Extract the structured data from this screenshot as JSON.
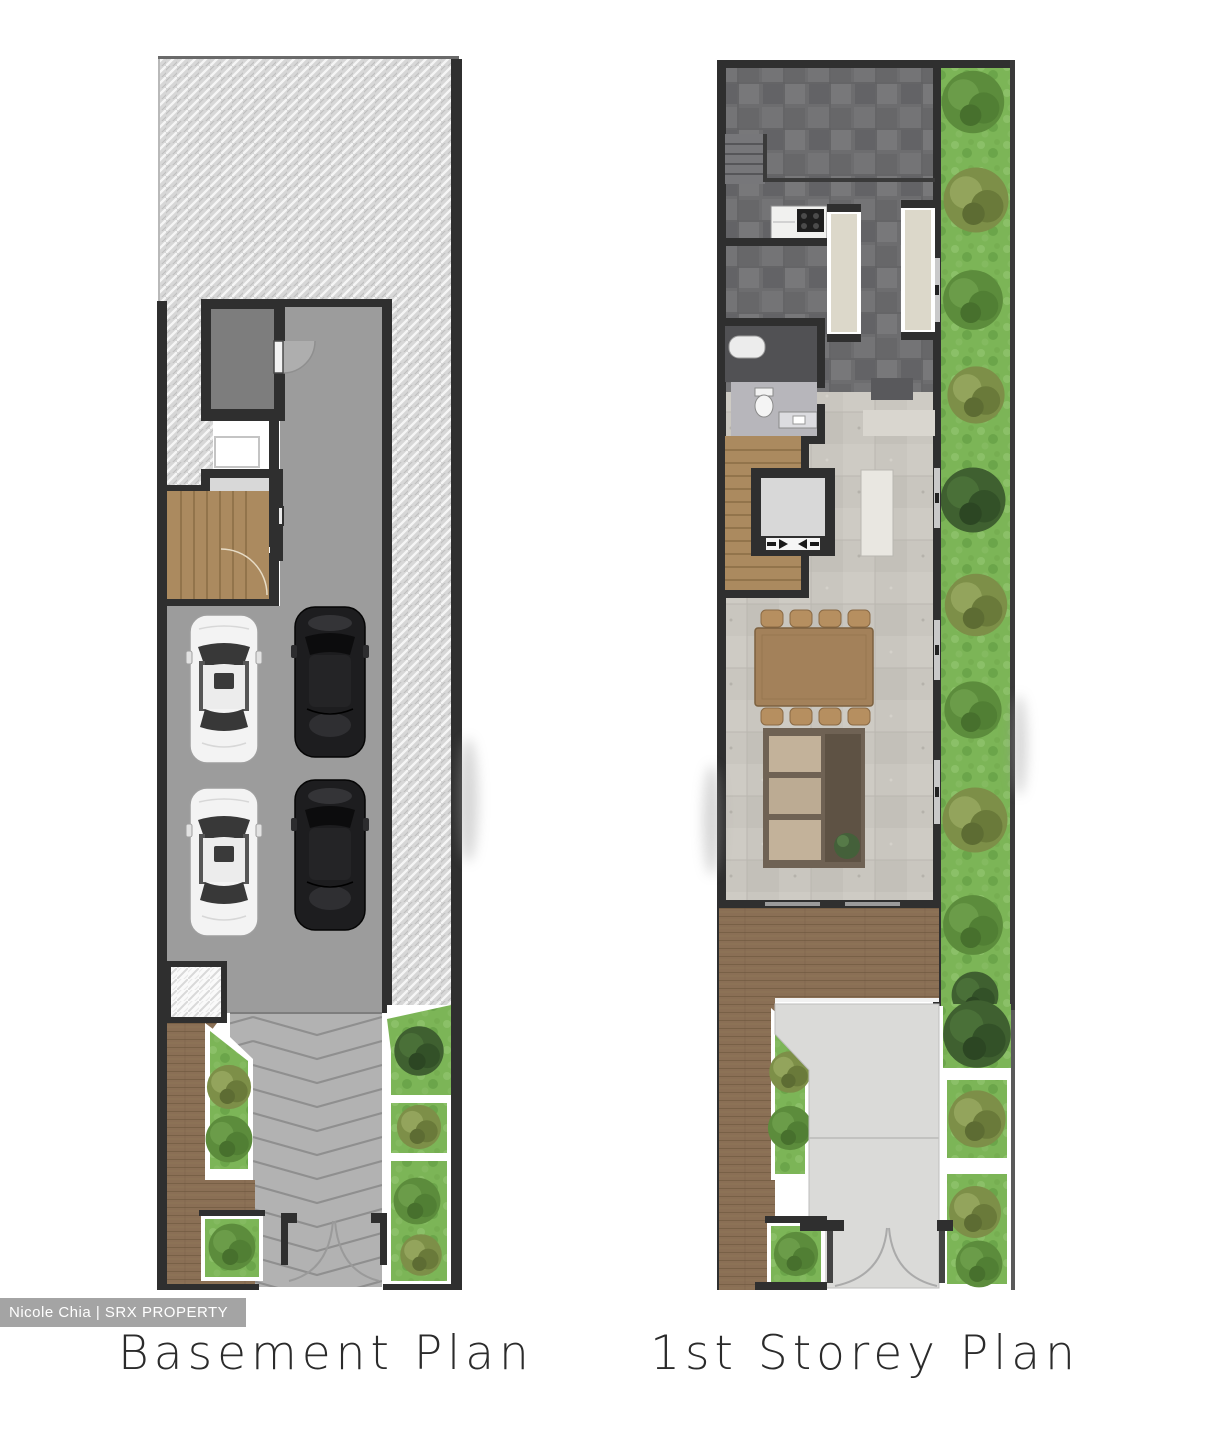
{
  "plans": [
    {
      "id": "basement",
      "label": "Basement Plan"
    },
    {
      "id": "first-storey",
      "label": "1st Storey Plan"
    }
  ],
  "watermark": {
    "text": "Nicole Chia | SRX PROPERTY",
    "bar_color": "#949494",
    "text_color": "#ffffff"
  },
  "palette": {
    "background": "#ffffff",
    "wall": "#2f2f2f",
    "earth_hatch": "#d7d7d7",
    "basement_floor": "#9c9c9c",
    "slate_paving": "#6d6d6f",
    "living_floor": "#c9c6bf",
    "timber_deck": "#8a6f55",
    "stair_timber": "#ab8a5f",
    "grass": "#7cb557",
    "driveway_basement": "#b2b2b2",
    "driveway_first_storey": "#dadad8",
    "lift_cabin": "#d8d8d8",
    "car_white": "#f3f3f3",
    "car_black": "#1d1d1f",
    "label_text": "#2b2b2b"
  }
}
